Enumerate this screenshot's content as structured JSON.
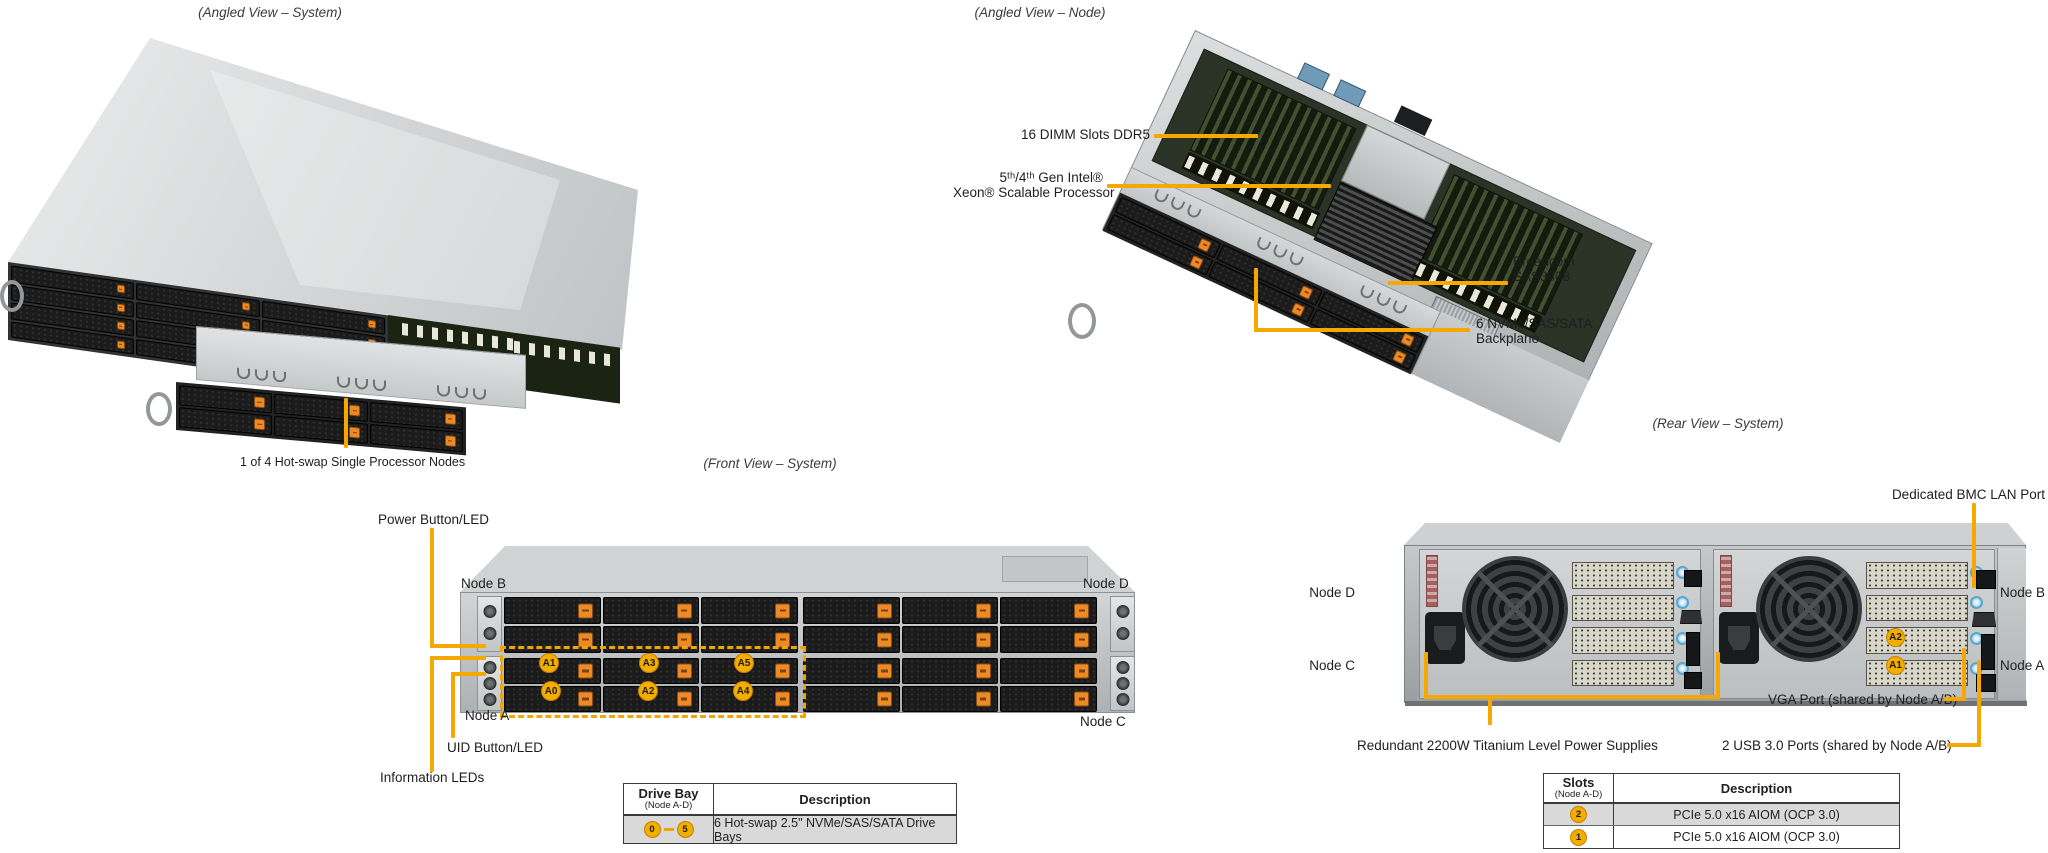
{
  "palette": {
    "callout": "#F7A800",
    "badge_bg": "#F2AE00",
    "drive_button": "#ED8A25",
    "table_row_gray": "#D9D9D9"
  },
  "titles": {
    "angled_system": "(Angled View – System)",
    "angled_node": "(Angled View – Node)",
    "front": "(Front View – System)",
    "rear": "(Rear View – System)"
  },
  "angled_system": {
    "caption": "1 of 4 Hot-swap Single Processor Nodes"
  },
  "angled_node": {
    "labels": {
      "dimm": "16 DIMM Slots DDR5",
      "cpu1": "5ᵗʰ/4ᵗʰ Gen Intel®",
      "cpu2": "Xeon® Scalable Processor",
      "sas1": "Broadcom",
      "sas2": "SAS3808",
      "bp1": "6 NVMe/SAS/SATA",
      "bp2": "Backplane"
    }
  },
  "front": {
    "labels": {
      "power": "Power Button/LED",
      "uid": "UID Button/LED",
      "info": "Information LEDs",
      "node_a": "Node A",
      "node_b": "Node B",
      "node_c": "Node C",
      "node_d": "Node D"
    },
    "drive_badges": [
      "A1",
      "A3",
      "A5",
      "A0",
      "A2",
      "A4"
    ]
  },
  "rear": {
    "labels": {
      "bmc": "Dedicated BMC LAN Port",
      "vga": "VGA Port (shared by Node A/B)",
      "usb": "2 USB 3.0 Ports (shared by Node A/B)",
      "psu": "Redundant 2200W Titanium Level Power Supplies",
      "node_a": "Node A",
      "node_b": "Node B",
      "node_c": "Node C",
      "node_d": "Node D"
    },
    "slot_badges": [
      "A2",
      "A1"
    ]
  },
  "tables": {
    "drive_bay": {
      "col1_title": "Drive Bay",
      "col1_sub": "(Node A-D)",
      "col2_title": "Description",
      "range_from": "0",
      "range_to": "5",
      "row_desc": "6 Hot-swap 2.5\" NVMe/SAS/SATA Drive Bays"
    },
    "slots": {
      "col1_title": "Slots",
      "col1_sub": "(Node A-D)",
      "col2_title": "Description",
      "rows": [
        {
          "badge": "2",
          "desc": "PCIe 5.0 x16 AIOM (OCP 3.0)"
        },
        {
          "badge": "1",
          "desc": "PCIe 5.0 x16 AIOM (OCP 3.0)"
        }
      ]
    }
  }
}
